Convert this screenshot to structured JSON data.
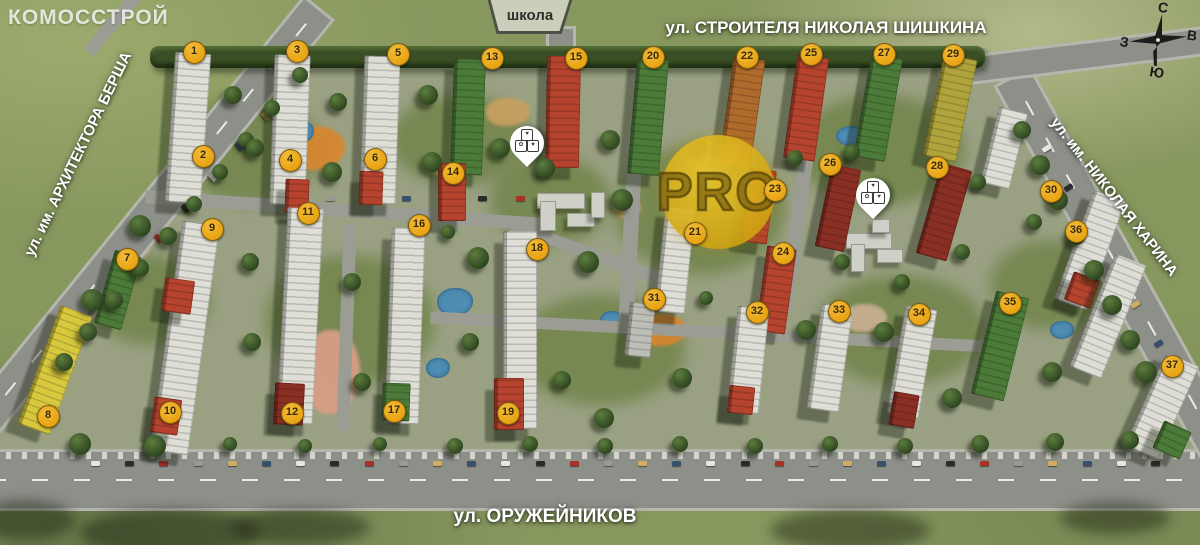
{
  "branding": {
    "logo": "КОМОССТРОЙ"
  },
  "watermark": {
    "text": "PRO"
  },
  "streets": {
    "top": "ул. СТРОИТЕЛЯ НИКОЛАЯ ШИШКИНА",
    "left": "ул. им. АРХИТЕКТОРА БЕРША",
    "right": "ул. им. НИКОЛАЯ ХАРИНА",
    "bottom": "ул. ОРУЖЕЙНИКОВ"
  },
  "school_sign": {
    "label": "школа"
  },
  "compass": {
    "north": "С",
    "south": "Ю",
    "west": "З",
    "east": "В"
  },
  "colors": {
    "marker_bg": "#E8A312",
    "marker_text": "#3A2A05",
    "watermark_gold": "#D4AF1E",
    "grass": "#87985F",
    "road": "#8D8F89",
    "road_internal": "#9B9D94",
    "sidewalk": "#B5B6AE",
    "hedge": "#3A4F24",
    "pond": "#4E8CB4",
    "white": "#DEDED6",
    "red": "#B5432E",
    "darkred": "#8A2F24",
    "green": "#4C7A38",
    "yellow": "#D8C83E",
    "olive": "#AFA43C",
    "orange": "#B06A2C",
    "gray": "#BDBFB6",
    "yard": "#6E8246",
    "playground_orange": "#D8862E",
    "playground_sand": "#C8A060",
    "path_salmon": "#D99E86",
    "sand_gray": "#C8B090"
  },
  "markers": [
    {
      "n": "1",
      "x": 193,
      "y": 51
    },
    {
      "n": "2",
      "x": 202,
      "y": 155
    },
    {
      "n": "3",
      "x": 296,
      "y": 50
    },
    {
      "n": "4",
      "x": 289,
      "y": 159
    },
    {
      "n": "5",
      "x": 397,
      "y": 53
    },
    {
      "n": "6",
      "x": 374,
      "y": 158
    },
    {
      "n": "7",
      "x": 126,
      "y": 258
    },
    {
      "n": "8",
      "x": 47,
      "y": 415
    },
    {
      "n": "9",
      "x": 211,
      "y": 228
    },
    {
      "n": "10",
      "x": 169,
      "y": 411
    },
    {
      "n": "11",
      "x": 307,
      "y": 212
    },
    {
      "n": "12",
      "x": 291,
      "y": 412
    },
    {
      "n": "13",
      "x": 491,
      "y": 57
    },
    {
      "n": "14",
      "x": 452,
      "y": 172
    },
    {
      "n": "15",
      "x": 575,
      "y": 57
    },
    {
      "n": "16",
      "x": 418,
      "y": 224
    },
    {
      "n": "17",
      "x": 393,
      "y": 410
    },
    {
      "n": "18",
      "x": 536,
      "y": 248
    },
    {
      "n": "19",
      "x": 507,
      "y": 412
    },
    {
      "n": "20",
      "x": 652,
      "y": 56
    },
    {
      "n": "21",
      "x": 694,
      "y": 232
    },
    {
      "n": "22",
      "x": 746,
      "y": 56
    },
    {
      "n": "23",
      "x": 774,
      "y": 189
    },
    {
      "n": "24",
      "x": 782,
      "y": 252
    },
    {
      "n": "25",
      "x": 810,
      "y": 53
    },
    {
      "n": "26",
      "x": 829,
      "y": 163
    },
    {
      "n": "27",
      "x": 883,
      "y": 53
    },
    {
      "n": "28",
      "x": 936,
      "y": 166
    },
    {
      "n": "29",
      "x": 952,
      "y": 54
    },
    {
      "n": "30",
      "x": 1050,
      "y": 190
    },
    {
      "n": "31",
      "x": 653,
      "y": 298
    },
    {
      "n": "32",
      "x": 756,
      "y": 311
    },
    {
      "n": "33",
      "x": 838,
      "y": 310
    },
    {
      "n": "34",
      "x": 918,
      "y": 313
    },
    {
      "n": "35",
      "x": 1009,
      "y": 302
    },
    {
      "n": "36",
      "x": 1075,
      "y": 230
    },
    {
      "n": "37",
      "x": 1171,
      "y": 365
    }
  ],
  "pins": [
    {
      "name": "kindergarten-pin-1",
      "x": 527,
      "y": 170,
      "icons": [
        "♥",
        "✿",
        "♥"
      ]
    },
    {
      "name": "kindergarten-pin-2",
      "x": 873,
      "y": 222,
      "icons": [
        "♥",
        "✿",
        "♥"
      ]
    }
  ],
  "scene": {
    "site": [
      [
        320,
        48
      ],
      [
        985,
        48
      ],
      [
        1032,
        92
      ],
      [
        1210,
        452
      ],
      [
        -50,
        452
      ]
    ],
    "hedge": [
      150,
      46,
      835,
      22
    ],
    "yards": [
      [
        250,
        150,
        70,
        55
      ],
      [
        460,
        140,
        70,
        45
      ],
      [
        700,
        210,
        85,
        65
      ],
      [
        880,
        150,
        85,
        55
      ],
      [
        350,
        320,
        85,
        65
      ],
      [
        600,
        350,
        85,
        55
      ],
      [
        900,
        330,
        85,
        55
      ],
      [
        1050,
        285,
        60,
        45
      ],
      [
        150,
        300,
        60,
        45
      ],
      [
        550,
        200,
        60,
        45
      ]
    ],
    "playgrounds": [
      [
        315,
        148,
        30,
        22,
        "playground_orange"
      ],
      [
        508,
        112,
        22,
        14,
        "playground_sand"
      ],
      [
        662,
        330,
        24,
        16,
        "playground_orange"
      ],
      [
        332,
        372,
        28,
        42,
        "path_salmon"
      ],
      [
        130,
        248,
        20,
        12,
        "path_salmon"
      ],
      [
        865,
        318,
        22,
        14,
        "sand_gray"
      ],
      [
        627,
        208,
        14,
        10,
        "playground_sand"
      ]
    ],
    "ponds": [
      [
        298,
        132,
        16,
        12
      ],
      [
        455,
        302,
        18,
        14
      ],
      [
        438,
        368,
        12,
        10
      ],
      [
        612,
        320,
        12,
        9
      ],
      [
        1062,
        330,
        12,
        9
      ],
      [
        852,
        136,
        16,
        10
      ]
    ],
    "roads": [
      [
        600,
        480,
        1220,
        56,
        0,
        "h",
        1,
        1,
        "main"
      ],
      [
        135,
        235,
        580,
        34,
        39,
        "v",
        1,
        0,
        "main"
      ],
      [
        1115,
        262,
        420,
        36,
        -29,
        "v",
        1,
        0,
        "main"
      ],
      [
        1075,
        57,
        270,
        24,
        -7,
        "h",
        0,
        0,
        "main"
      ],
      [
        561,
        52,
        46,
        24,
        0,
        "v",
        0,
        0,
        "main"
      ],
      [
        112,
        24,
        74,
        13,
        40,
        "v",
        0,
        0,
        "int"
      ],
      [
        345,
        210,
        400,
        13,
        4,
        "h",
        0,
        0,
        "int"
      ],
      [
        592,
        254,
        170,
        12,
        20,
        "h",
        0,
        0,
        "int"
      ],
      [
        632,
        198,
        270,
        15,
        3,
        "v",
        0,
        0,
        "int"
      ],
      [
        800,
        203,
        220,
        14,
        8,
        "v",
        0,
        0,
        "int"
      ],
      [
        346,
        328,
        206,
        13,
        2,
        "v",
        0,
        0,
        "int"
      ],
      [
        710,
        332,
        560,
        12,
        3,
        "h",
        0,
        0,
        "int"
      ]
    ],
    "buildings": [
      [
        188,
        128,
        36,
        150,
        4,
        "white"
      ],
      [
        290,
        130,
        36,
        150,
        2,
        "white"
      ],
      [
        297,
        196,
        24,
        34,
        2,
        "red"
      ],
      [
        380,
        130,
        36,
        148,
        2,
        "white"
      ],
      [
        371,
        188,
        24,
        34,
        2,
        "red"
      ],
      [
        468,
        117,
        32,
        116,
        2,
        "green"
      ],
      [
        563,
        112,
        34,
        112,
        1,
        "red"
      ],
      [
        648,
        117,
        32,
        116,
        5,
        "green"
      ],
      [
        742,
        112,
        32,
        108,
        8,
        "orange"
      ],
      [
        806,
        108,
        32,
        104,
        8,
        "red"
      ],
      [
        878,
        108,
        32,
        104,
        10,
        "green"
      ],
      [
        950,
        108,
        34,
        104,
        12,
        "olive"
      ],
      [
        118,
        290,
        28,
        76,
        16,
        "green"
      ],
      [
        55,
        370,
        34,
        126,
        20,
        "yellow"
      ],
      [
        185,
        338,
        38,
        232,
        8,
        "white"
      ],
      [
        178,
        296,
        30,
        34,
        8,
        "red"
      ],
      [
        166,
        416,
        28,
        36,
        8,
        "red"
      ],
      [
        300,
        316,
        36,
        216,
        3,
        "white"
      ],
      [
        289,
        404,
        30,
        42,
        3,
        "darkred"
      ],
      [
        452,
        192,
        28,
        58,
        0,
        "red"
      ],
      [
        405,
        326,
        34,
        196,
        2,
        "white"
      ],
      [
        396,
        402,
        28,
        38,
        2,
        "green"
      ],
      [
        520,
        330,
        34,
        198,
        0,
        "white"
      ],
      [
        509,
        404,
        30,
        52,
        0,
        "red"
      ],
      [
        675,
        260,
        30,
        106,
        6,
        "white"
      ],
      [
        758,
        206,
        28,
        74,
        8,
        "red"
      ],
      [
        776,
        290,
        30,
        86,
        8,
        "red"
      ],
      [
        640,
        330,
        26,
        54,
        6,
        "gray"
      ],
      [
        748,
        360,
        32,
        106,
        6,
        "white"
      ],
      [
        741,
        400,
        26,
        28,
        6,
        "red"
      ],
      [
        830,
        358,
        32,
        106,
        8,
        "white"
      ],
      [
        912,
        362,
        32,
        110,
        10,
        "white"
      ],
      [
        904,
        410,
        26,
        34,
        10,
        "darkred"
      ],
      [
        1000,
        346,
        34,
        106,
        14,
        "green"
      ],
      [
        838,
        208,
        30,
        84,
        12,
        "darkred"
      ],
      [
        944,
        212,
        32,
        94,
        16,
        "darkred"
      ],
      [
        1004,
        148,
        30,
        78,
        14,
        "white"
      ],
      [
        1090,
        250,
        34,
        116,
        20,
        "white"
      ],
      [
        1082,
        290,
        28,
        30,
        20,
        "red"
      ],
      [
        1108,
        316,
        34,
        122,
        22,
        "white"
      ],
      [
        1162,
        406,
        36,
        102,
        24,
        "white"
      ],
      [
        1172,
        440,
        30,
        30,
        24,
        "green"
      ]
    ],
    "blocks": [
      [
        560,
        200,
        46,
        14
      ],
      [
        547,
        215,
        14,
        28
      ],
      [
        580,
        219,
        26,
        12
      ],
      [
        597,
        204,
        12,
        24
      ],
      [
        868,
        240,
        44,
        14
      ],
      [
        857,
        257,
        12,
        26
      ],
      [
        889,
        255,
        24,
        12
      ],
      [
        880,
        225,
        16,
        12
      ]
    ],
    "trees": [
      [
        300,
        75
      ],
      [
        272,
        108
      ],
      [
        246,
        140
      ],
      [
        220,
        172
      ],
      [
        194,
        204
      ],
      [
        168,
        236
      ],
      [
        140,
        268
      ],
      [
        114,
        300
      ],
      [
        88,
        332
      ],
      [
        64,
        362
      ],
      [
        1022,
        130
      ],
      [
        1040,
        165
      ],
      [
        1058,
        200
      ],
      [
        1076,
        235
      ],
      [
        1094,
        270
      ],
      [
        1112,
        305
      ],
      [
        1130,
        340
      ],
      [
        1146,
        372
      ],
      [
        80,
        444
      ],
      [
        155,
        446
      ],
      [
        230,
        444
      ],
      [
        305,
        446
      ],
      [
        380,
        444
      ],
      [
        455,
        446
      ],
      [
        530,
        444
      ],
      [
        605,
        446
      ],
      [
        680,
        444
      ],
      [
        755,
        446
      ],
      [
        830,
        444
      ],
      [
        905,
        446
      ],
      [
        980,
        444
      ],
      [
        1055,
        442
      ],
      [
        1130,
        440
      ],
      [
        233,
        95
      ],
      [
        255,
        148
      ],
      [
        338,
        102
      ],
      [
        332,
        172
      ],
      [
        428,
        95
      ],
      [
        432,
        162
      ],
      [
        500,
        148
      ],
      [
        545,
        168
      ],
      [
        610,
        140
      ],
      [
        622,
        200
      ],
      [
        588,
        262
      ],
      [
        478,
        258
      ],
      [
        448,
        232
      ],
      [
        700,
        148
      ],
      [
        706,
        298
      ],
      [
        795,
        158
      ],
      [
        852,
        152
      ],
      [
        842,
        262
      ],
      [
        902,
        282
      ],
      [
        962,
        252
      ],
      [
        978,
        182
      ],
      [
        1034,
        222
      ],
      [
        250,
        262
      ],
      [
        252,
        342
      ],
      [
        352,
        282
      ],
      [
        362,
        382
      ],
      [
        470,
        342
      ],
      [
        562,
        380
      ],
      [
        604,
        418
      ],
      [
        682,
        378
      ],
      [
        806,
        330
      ],
      [
        884,
        332
      ],
      [
        952,
        398
      ],
      [
        1052,
        372
      ],
      [
        140,
        226
      ],
      [
        92,
        300
      ]
    ],
    "tree_shadows": [
      [
        170,
        533,
        90,
        24
      ],
      [
        300,
        527,
        70,
        18
      ],
      [
        850,
        530,
        80,
        20
      ],
      [
        1115,
        518,
        55,
        16
      ],
      [
        25,
        520,
        50,
        20
      ]
    ],
    "car_strips": [
      [
        95,
        463,
        1155,
        463,
        32,
        0
      ],
      [
        292,
        85,
        78,
        330,
        9,
        50
      ],
      [
        1046,
        148,
        1180,
        382,
        7,
        -32
      ],
      [
        330,
        198,
        520,
        198,
        6,
        0
      ]
    ],
    "car_colors": [
      "#e8e8e2",
      "#2a2a2a",
      "#a83226",
      "#9a9a94",
      "#cfae62",
      "#36506e"
    ]
  }
}
